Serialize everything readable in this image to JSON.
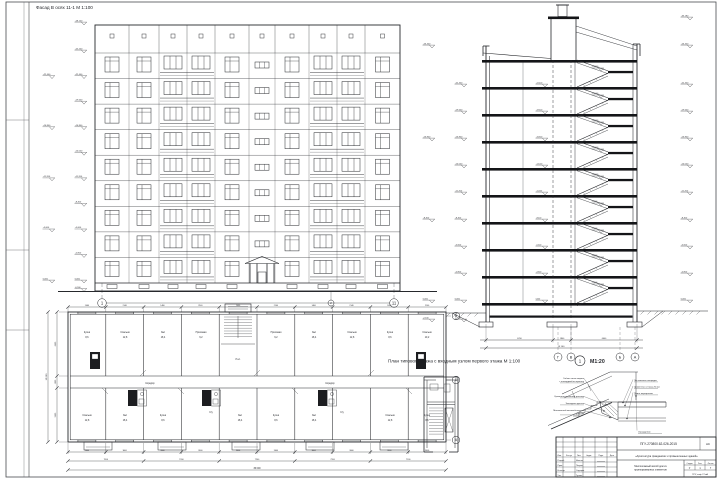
{
  "sheet": {
    "facade": {
      "title": "Фасад В осях 11-1 М 1:100",
      "axis_left": "1",
      "axis_mid": "2",
      "axis_right": "11",
      "floors": 9,
      "columns": [
        "w",
        "w",
        "b",
        "b",
        "w",
        "s",
        "w",
        "b",
        "b",
        "w"
      ],
      "elev_inner": [
        "+28,100",
        "+25,200",
        "+22,400",
        "+19,600",
        "+16,800",
        "+14,000",
        "+11,200",
        "+8,400",
        "+5,600",
        "+2,800",
        "0,000",
        "-0,900"
      ],
      "elev_outer": [
        "+22,400",
        "+16,800",
        "+11,200",
        "+5,600",
        "0,000"
      ]
    },
    "section": {
      "elev_right": [
        "+33,180",
        "+26,400",
        "+22,400",
        "+19,600",
        "+16,800",
        "+14,000",
        "+11,200",
        "+8,400",
        "+5,600",
        "+2,800",
        "0,000"
      ],
      "elev_left_inner": [
        "+22,400",
        "+19,600",
        "+16,800",
        "+14,000",
        "+11,200",
        "+8,400",
        "+5,600",
        "+2,800",
        "0,000",
        "-1,800"
      ],
      "elev_left_outer": [
        "+26,400",
        "+16,800",
        "+8,400",
        "0,000",
        "-2,100"
      ],
      "elev_mid": [
        "+22,400",
        "+19,600",
        "+16,800",
        "+14,000",
        "+11,200",
        "+8,400",
        "+5,600",
        "+2,800",
        "0,000"
      ],
      "elev_land": [
        "+23,800",
        "+21,000",
        "+18,200",
        "+15,400",
        "+12,600",
        "+9,800",
        "+7,000",
        "+4,200",
        "+1,400"
      ],
      "dims": [
        "6700",
        "1800",
        "6600"
      ],
      "dim_total": "15 100",
      "axes": [
        "Г",
        "В",
        "Б",
        "А"
      ]
    },
    "plan": {
      "title": "План типового этажа с входным узлом первого этажа М 1:100",
      "detail_ref": "1",
      "detail_scale": "М1:20",
      "axes_right": [
        "В",
        "Б",
        "А"
      ],
      "dims_top": [
        "1460",
        "2140",
        "1460",
        "2140",
        "1460",
        "2140",
        "1460",
        "2140",
        "1460",
        "2140"
      ],
      "dims_row1": [
        "3600",
        "3600",
        "3600",
        "3600",
        "3600",
        "3600",
        "3600",
        "3600",
        "3600",
        "3600"
      ],
      "dims_row2": [
        "7200",
        "7200",
        "7200",
        "7200",
        "7200"
      ],
      "dim_total": "36 000",
      "dims_left": [
        "6400",
        "1200",
        "5400"
      ],
      "dim_left_total": "13 000",
      "rooms": [
        {
          "t": "Кухня",
          "x": 87,
          "y": 333
        },
        {
          "t": "8,6",
          "x": 87,
          "y": 338
        },
        {
          "t": "Спальня",
          "x": 125,
          "y": 333
        },
        {
          "t": "12,8",
          "x": 125,
          "y": 338
        },
        {
          "t": "Зал",
          "x": 163,
          "y": 333
        },
        {
          "t": "18,4",
          "x": 163,
          "y": 338
        },
        {
          "t": "Прихожая",
          "x": 201,
          "y": 333
        },
        {
          "t": "6,2",
          "x": 201,
          "y": 338
        },
        {
          "t": "Л.кл.",
          "x": 238,
          "y": 360
        },
        {
          "t": "Прихожая",
          "x": 276,
          "y": 333
        },
        {
          "t": "6,2",
          "x": 276,
          "y": 338
        },
        {
          "t": "Зал",
          "x": 314,
          "y": 333
        },
        {
          "t": "18,4",
          "x": 314,
          "y": 338
        },
        {
          "t": "Спальня",
          "x": 352,
          "y": 333
        },
        {
          "t": "12,8",
          "x": 352,
          "y": 338
        },
        {
          "t": "Кухня",
          "x": 390,
          "y": 333
        },
        {
          "t": "8,6",
          "x": 390,
          "y": 338
        },
        {
          "t": "Спальня",
          "x": 427,
          "y": 333
        },
        {
          "t": "10,2",
          "x": 427,
          "y": 338
        },
        {
          "t": "Коридор",
          "x": 150,
          "y": 384
        },
        {
          "t": "Коридор",
          "x": 330,
          "y": 384
        },
        {
          "t": "Спальня",
          "x": 87,
          "y": 416
        },
        {
          "t": "12,8",
          "x": 87,
          "y": 421
        },
        {
          "t": "Зал",
          "x": 125,
          "y": 416
        },
        {
          "t": "18,4",
          "x": 125,
          "y": 421
        },
        {
          "t": "Кухня",
          "x": 163,
          "y": 416
        },
        {
          "t": "8,6",
          "x": 163,
          "y": 421
        },
        {
          "t": "С/у",
          "x": 211,
          "y": 413
        },
        {
          "t": "Зал",
          "x": 240,
          "y": 416
        },
        {
          "t": "18,4",
          "x": 240,
          "y": 421
        },
        {
          "t": "Кухня",
          "x": 276,
          "y": 416
        },
        {
          "t": "8,6",
          "x": 276,
          "y": 421
        },
        {
          "t": "С/у",
          "x": 342,
          "y": 413
        },
        {
          "t": "Зал",
          "x": 314,
          "y": 416
        },
        {
          "t": "18,4",
          "x": 314,
          "y": 421
        },
        {
          "t": "Спальня",
          "x": 390,
          "y": 416
        },
        {
          "t": "12,8",
          "x": 390,
          "y": 421
        },
        {
          "t": "Кухня",
          "x": 427,
          "y": 416
        },
        {
          "t": "8,6",
          "x": 427,
          "y": 421
        }
      ]
    },
    "detail": {
      "left_notes": [
        {
          "lines": [
            "Гибкая связь марша",
            "с площадкой по проекту"
          ],
          "y": 378
        },
        {
          "lines": [
            "Цементно-песчаный раствор"
          ],
          "y": 396
        },
        {
          "lines": [
            "Закладная деталь"
          ],
          "y": 403
        },
        {
          "lines": [
            "Монолитный железобетонный",
            "участок"
          ],
          "y": 410
        }
      ],
      "right_notes": [
        {
          "lines": [
            "Лестничная площадка"
          ],
          "y": 380
        },
        {
          "lines": [
            "Цементная стяжка 20 мм"
          ],
          "y": 386.5
        },
        {
          "lines": [
            "Плита перекрытия"
          ],
          "y": 393
        },
        {
          "lines": [
            "Ограждение"
          ],
          "y": 431.5
        }
      ]
    },
    "titleblock": {
      "code": "ПГУ-270800.62-026-2015",
      "mark": "АС",
      "theme": "«Архитектура гражданских и промышленных зданий»",
      "object1": "Многоэтажный жилой дом из",
      "object2": "крупноразмерных элементов",
      "cols": [
        "Изм.",
        "Кол.уч",
        "Лист",
        "№док.",
        "Подп.",
        "Дата"
      ],
      "roles": [
        [
          "Разраб.",
          "Иванов"
        ],
        [
          "Пров.",
          "Петров"
        ],
        [
          "Н.контр.",
          "Сидоров"
        ],
        [
          "Утв.",
          "Гусева"
        ]
      ],
      "stage_h": [
        "Стадия",
        "Лист",
        "Листов"
      ],
      "stage_v": [
        "У",
        "1",
        "7"
      ],
      "org": "ПГУ, каф. ГСиА"
    }
  }
}
